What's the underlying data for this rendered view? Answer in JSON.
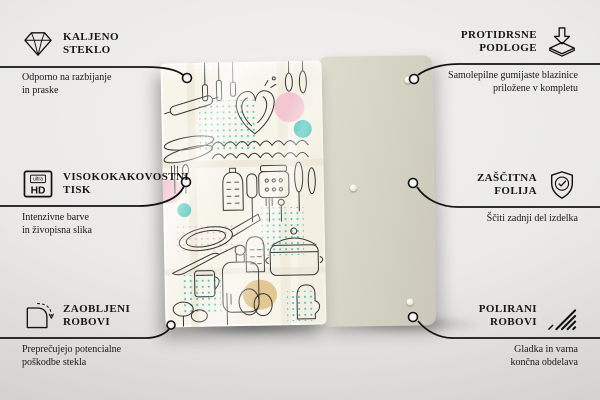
{
  "callouts": {
    "left": [
      {
        "icon": "diamond-icon",
        "title_line1": "KALJENO",
        "title_line2": "STEKLO",
        "desc_line1": "Odporno na razbijanje",
        "desc_line2": "in praske"
      },
      {
        "icon": "ultra-hd-icon",
        "icon_text_top": "ultra",
        "icon_text_main": "HD",
        "title_line1": "VISOKOKAKOVOSTNI",
        "title_line2": "TISK",
        "desc_line1": "Intenzivne barve",
        "desc_line2": "in živopisna slika"
      },
      {
        "icon": "rounded-corner-icon",
        "title_line1": "ZAOBLJENI",
        "title_line2": "ROBOVI",
        "desc_line1": "Preprečujejo potencialne",
        "desc_line2": "poškodbe stekla"
      }
    ],
    "right": [
      {
        "icon": "non-slip-pads-icon",
        "title_line1": "PROTIDRSNE",
        "title_line2": "PODLOGE",
        "desc_line1": "Samolepilne gumijaste blazinice",
        "desc_line2": "priložene v kompletu"
      },
      {
        "icon": "shield-check-icon",
        "title_line1": "ZAŠČITNA",
        "title_line2": "FOLIJA",
        "desc_line1": "Ščiti zadnji del izdelka",
        "desc_line2": ""
      },
      {
        "icon": "polished-edges-icon",
        "title_line1": "POLIRANI",
        "title_line2": "ROBOVI",
        "desc_line1": "Gladka in varna",
        "desc_line2": "končna obdelava"
      }
    ]
  },
  "product": {
    "front_panel": "kitchen-doodle-print-glass-board",
    "back_panel": "plain-back-board-with-pads"
  },
  "colors": {
    "accent_teal": "#3fbfb5",
    "accent_pink": "#f3c6d2",
    "accent_tan": "#e3c793",
    "line": "#141414",
    "glass_bg": "#f7f4ea",
    "back_panel": "#d6d4c5"
  }
}
